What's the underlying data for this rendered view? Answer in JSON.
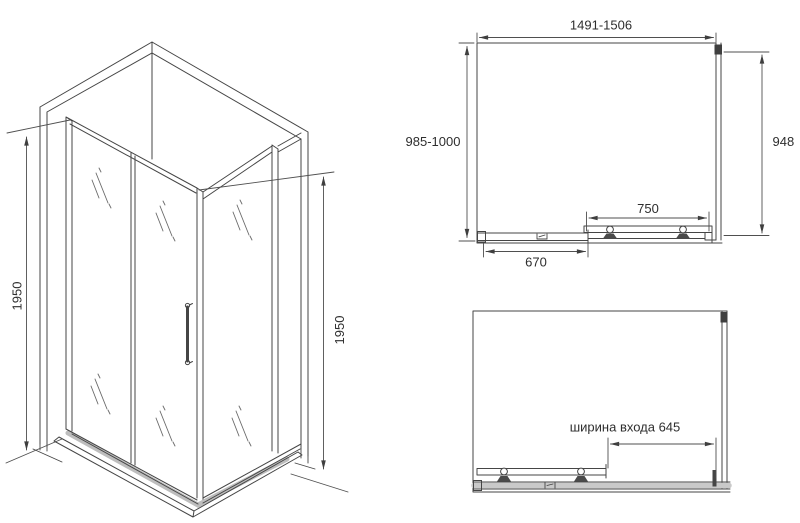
{
  "drawing": {
    "background_color": "#ffffff",
    "line_color": "#454545",
    "dim_line_color": "#4f4f4f",
    "text_color": "#2e2e2e",
    "views": {
      "isometric": {
        "height_left": "1950",
        "height_right": "1950"
      },
      "top_closed": {
        "width_range": "1491-1506",
        "depth_range": "985-1000",
        "side_panel": "948",
        "door_panel": "750",
        "fixed_panel": "670"
      },
      "top_open": {
        "entrance_width": "ширина входа 645"
      }
    }
  }
}
